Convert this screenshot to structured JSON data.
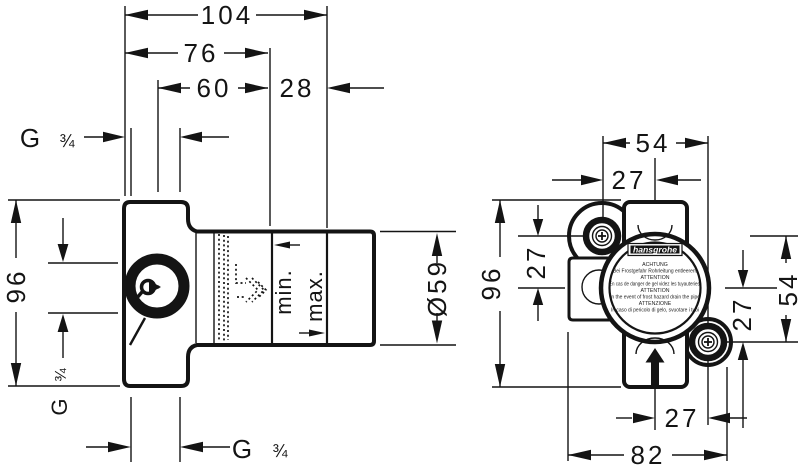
{
  "colors": {
    "line": "#141414",
    "background": "#ffffff"
  },
  "left_view": {
    "dims": {
      "overall_depth": "104",
      "depth_to_min": "76",
      "depth_60": "60",
      "min_max_range": "28",
      "height": "96",
      "diameter": "Ø59",
      "min": "min.",
      "max": "max."
    },
    "thread": {
      "g": "G",
      "frac": "¾"
    }
  },
  "right_view": {
    "dims": {
      "width": "54",
      "width_half": "27",
      "height": "96",
      "offset_left": "27",
      "offset_right": "27",
      "port_span": "54",
      "offset_bottom": "27",
      "overall_width": "82"
    },
    "label": {
      "brand": "hansgrohe",
      "lines": [
        "ACHTUNG",
        "Bei Frostgefahr Rohrleitung entleeren!",
        "ATTENTION",
        "En cas de danger de gel videz les tuyauteries!",
        "ATTENTION",
        "In the event of frost hazard drain the pipe",
        "ATTENZIONE",
        "In caso di pericolo di gelo, svuotare i tubi"
      ]
    }
  }
}
